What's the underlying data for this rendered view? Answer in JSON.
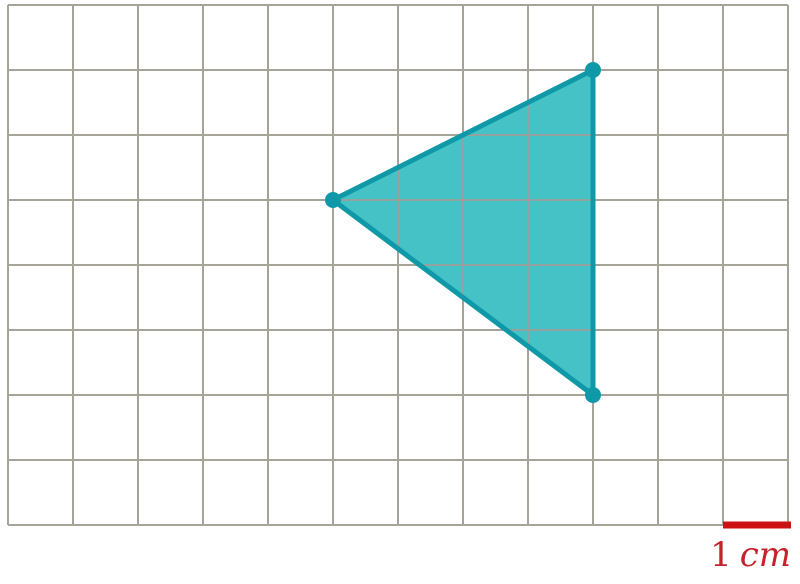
{
  "figure": {
    "background_color": "#ffffff",
    "grid": {
      "columns": 12,
      "rows": 8,
      "cell_size_px": 65,
      "origin_x": 8,
      "origin_y": 5,
      "line_color": "#a6a399",
      "line_width": 2,
      "inner_line_color": "#93a29e"
    },
    "triangle": {
      "fill_color": "#45c2c6",
      "stroke_color": "#0f99a8",
      "stroke_width": 5,
      "vertex_radius": 8,
      "vertices_grid": [
        {
          "col": 9,
          "row": 1
        },
        {
          "col": 5,
          "row": 3
        },
        {
          "col": 9,
          "row": 6
        }
      ]
    },
    "scale": {
      "bar_color": "#cc1212",
      "bar_length_cells": 1,
      "bar_thickness_px": 7,
      "label": "1 cm",
      "label_number": "1",
      "label_unit": "cm",
      "label_color": "#c4232b"
    }
  }
}
